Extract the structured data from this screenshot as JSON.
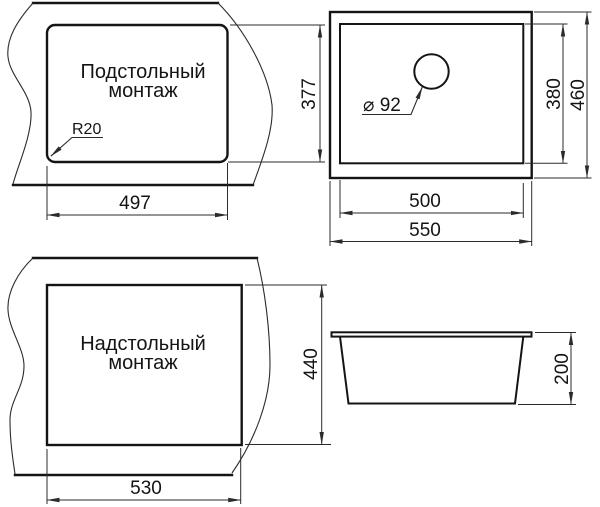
{
  "colors": {
    "line": "#141414",
    "thin_line": "#2b2b2b",
    "background": "#ffffff"
  },
  "views": {
    "undermount_cutout": {
      "title_line1": "Подстольный",
      "title_line2": "монтаж",
      "corner_radius_label": "R20",
      "width_label": "497"
    },
    "top_plan": {
      "cutout_height_label": "377",
      "hole_label": "⌀ 92",
      "inner_width_label": "500",
      "outer_width_label": "550",
      "inner_depth_label": "380",
      "outer_depth_label": "460"
    },
    "topmount_cutout": {
      "title_line1": "Надстольный",
      "title_line2": "монтаж",
      "width_label": "530",
      "height_label": "440"
    },
    "side_profile": {
      "bowl_height_label": "200"
    }
  }
}
